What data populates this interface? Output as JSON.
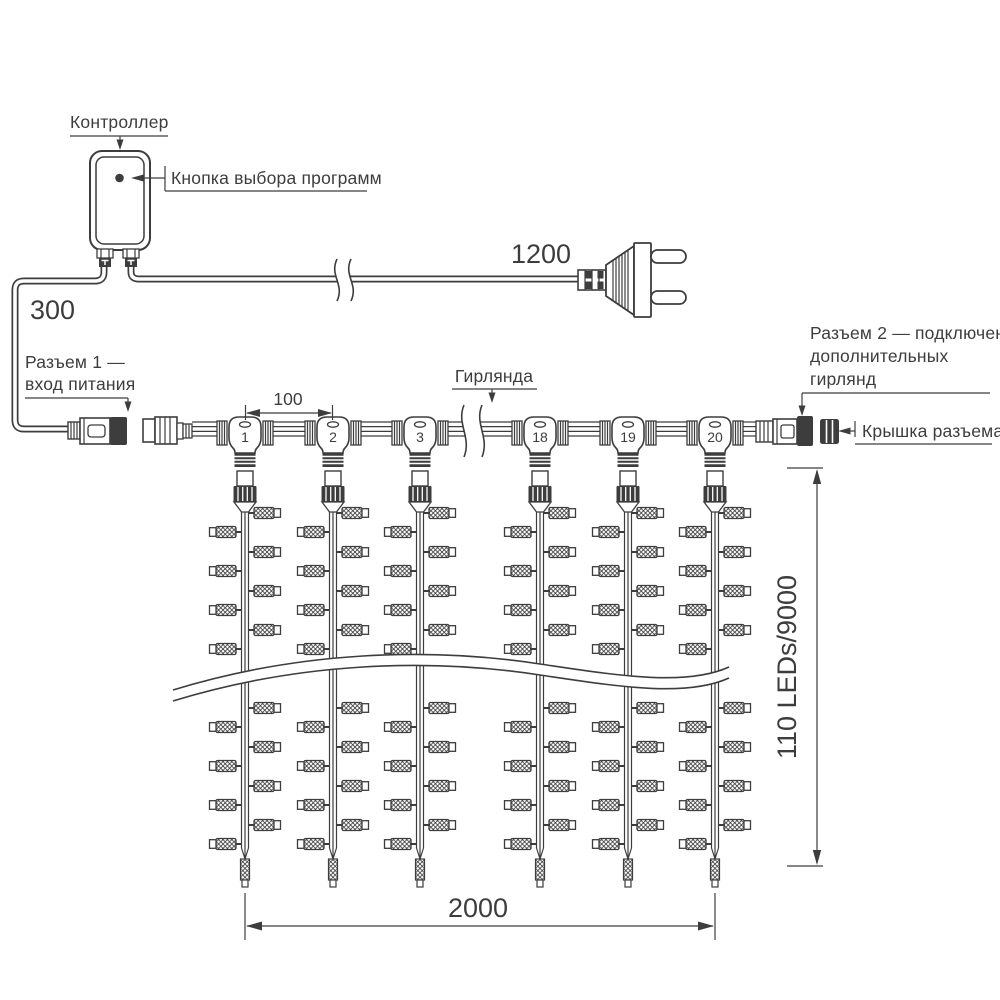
{
  "colors": {
    "ink": "#3d3d3d",
    "background": "#ffffff"
  },
  "labels": {
    "controller": "Контроллер",
    "program_button": "Кнопка выбора программ",
    "cord_length": "1200",
    "lead_length": "300",
    "connector1_line1": "Разъем 1 —",
    "connector1_line2": "вход питания",
    "garland": "Гирлянда",
    "drop_spacing": "100",
    "connector2_line1": "Разъем 2 — подключение",
    "connector2_line2": "дополнительных",
    "connector2_line3": "гирлянд",
    "cap": "Крышка разъема",
    "height": "110 LEDs/9000",
    "width": "2000"
  },
  "drops": [
    "1",
    "2",
    "3",
    "18",
    "19",
    "20"
  ]
}
